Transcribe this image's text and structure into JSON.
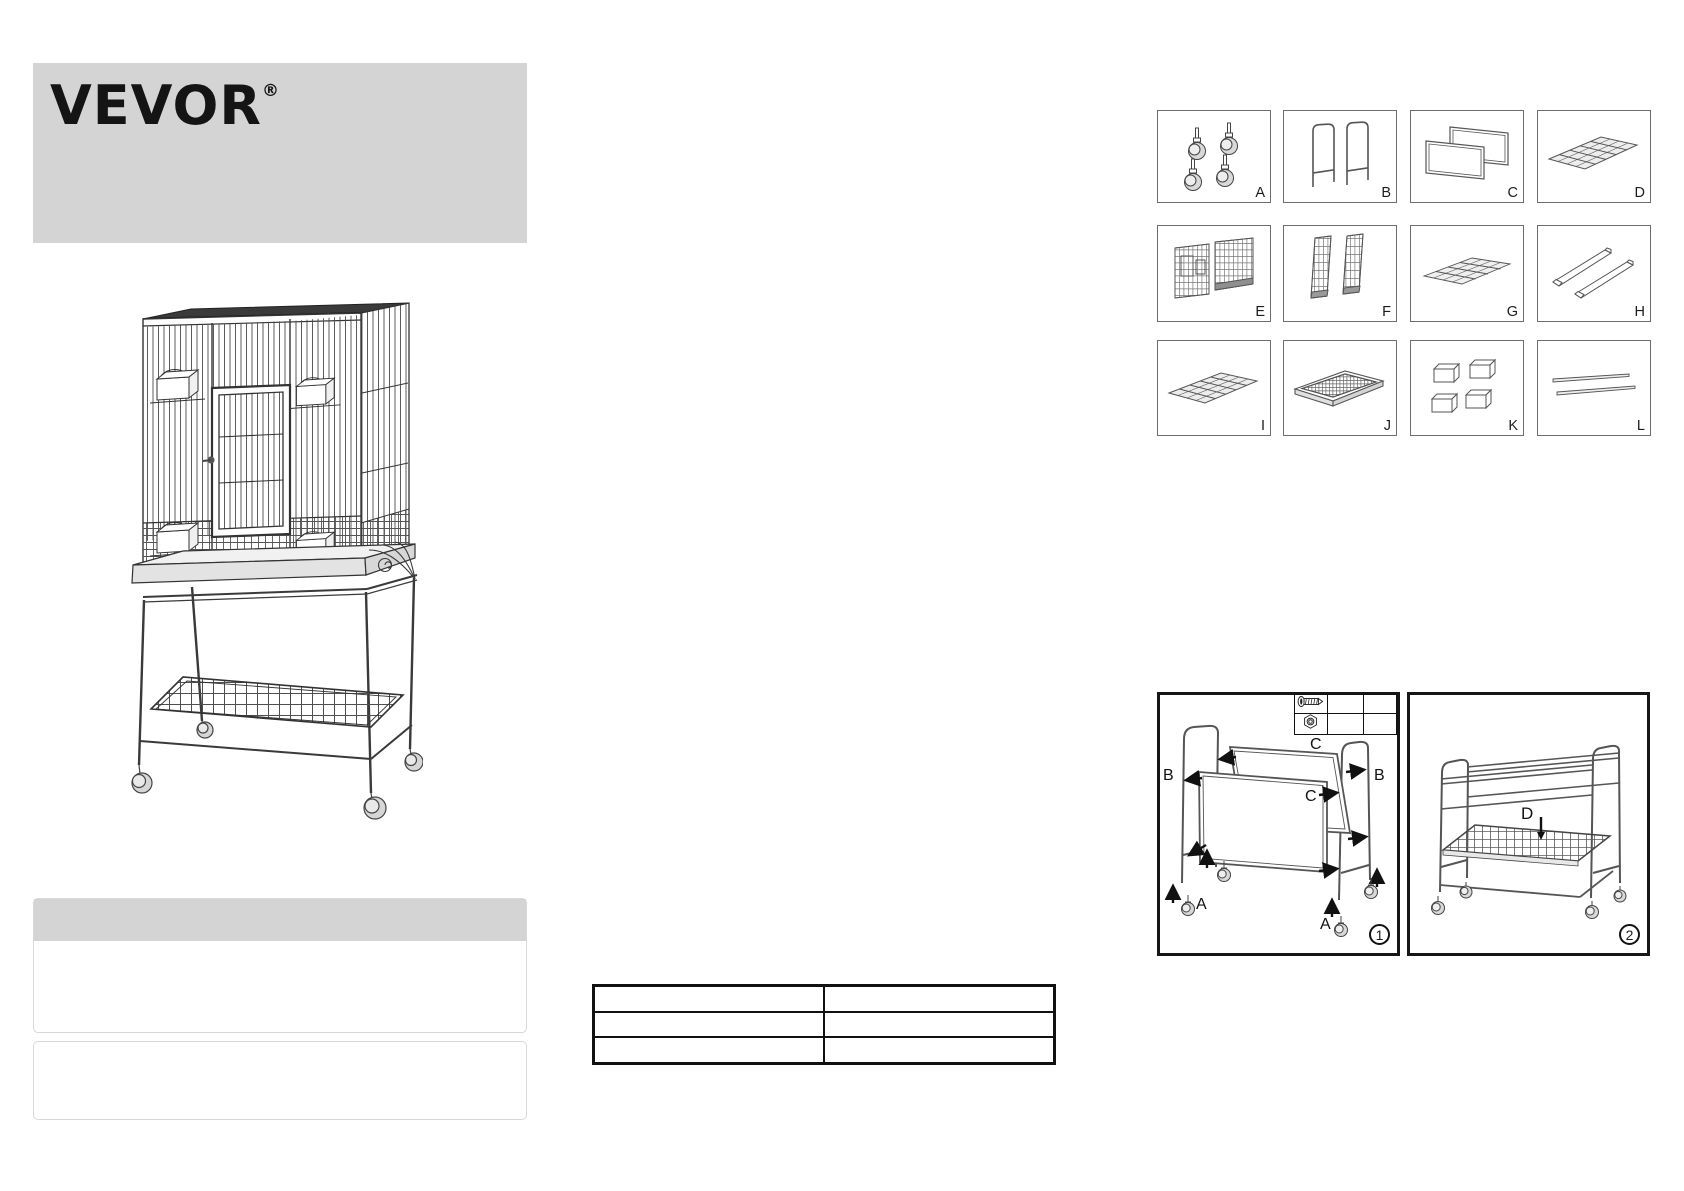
{
  "header": {
    "banner_color": "#d4d4d4",
    "logo_text": "VEVOR",
    "registered_mark": "®"
  },
  "parts_grid": {
    "box_labels": [
      "A",
      "B",
      "C",
      "D",
      "E",
      "F",
      "G",
      "H",
      "I",
      "J",
      "K",
      "L"
    ],
    "box_icons": [
      "caster-wheels-icon",
      "stand-side-frames-icon",
      "stand-support-frames-icon",
      "mesh-shelf-icon",
      "cage-front-back-panels-icon",
      "cage-side-panels-icon",
      "cage-floor-grate-icon",
      "support-rails-icon",
      "mesh-shelf-flat-icon",
      "slide-out-tray-icon",
      "feeder-cups-icon",
      "perch-rods-icon"
    ]
  },
  "assembly": {
    "step1": {
      "step_number": "1",
      "labels": {
        "c_top": "C",
        "b_left": "B",
        "b_right": "B",
        "c_middle": "C",
        "a_bottom_left": "A",
        "a_bottom_right": "A"
      },
      "hardware_icons": [
        "screw-icon",
        "nut-icon"
      ]
    },
    "step2": {
      "step_number": "2",
      "labels": {
        "d": "D"
      },
      "icons": {
        "down_arrow": "↓"
      }
    }
  },
  "spec_table": {
    "rows": [
      [
        "",
        ""
      ],
      [
        "",
        ""
      ],
      [
        "",
        ""
      ]
    ]
  },
  "colors": {
    "banner_gray": "#d4d4d4",
    "line_dark": "#333333",
    "panel_border": "#161616"
  }
}
